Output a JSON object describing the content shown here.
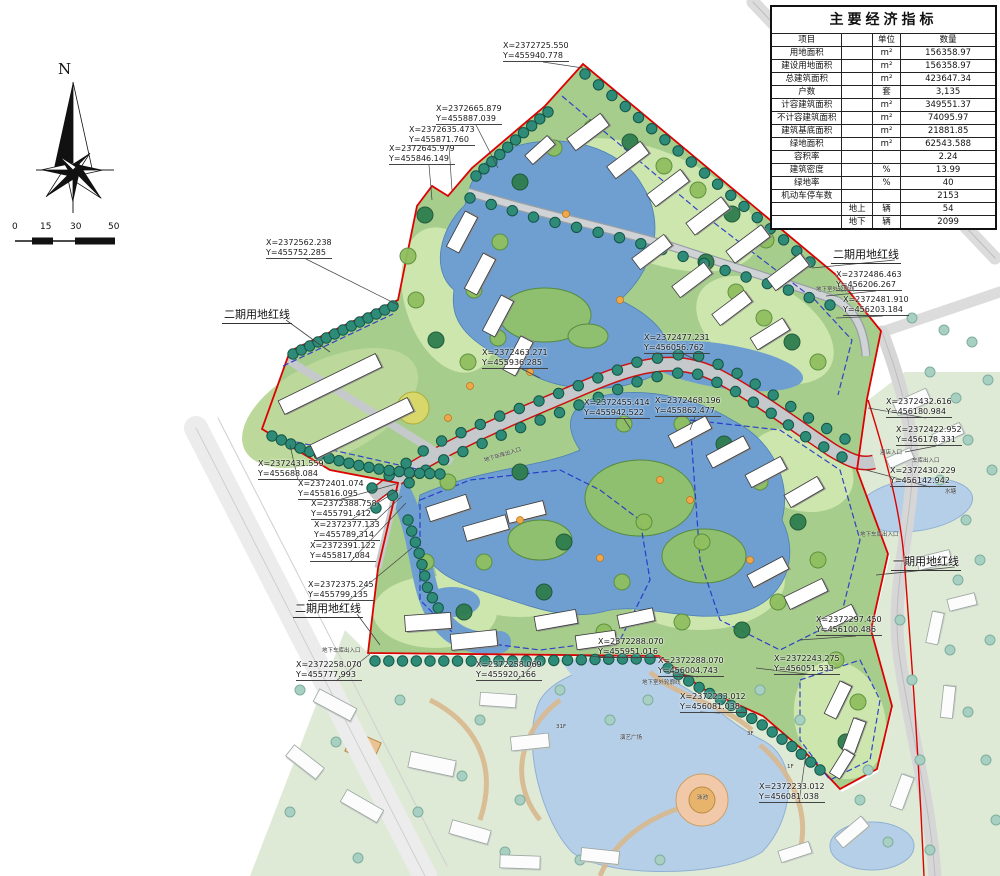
{
  "table": {
    "title": "主要经济指标",
    "header": {
      "item": "项目",
      "sub": "",
      "unit": "单位",
      "qty": "数量"
    },
    "rows": [
      {
        "item": "用地面积",
        "sub": "",
        "unit": "m²",
        "qty": "156358.97"
      },
      {
        "item": "建设用地面积",
        "sub": "",
        "unit": "m²",
        "qty": "156358.97"
      },
      {
        "item": "总建筑面积",
        "sub": "",
        "unit": "m²",
        "qty": "423647.34"
      },
      {
        "item": "户数",
        "sub": "",
        "unit": "套",
        "qty": "3,135"
      },
      {
        "item": "计容建筑面积",
        "sub": "",
        "unit": "m²",
        "qty": "349551.37"
      },
      {
        "item": "不计容建筑面积",
        "sub": "",
        "unit": "m²",
        "qty": "74095.97"
      },
      {
        "item": "建筑基底面积",
        "sub": "",
        "unit": "m²",
        "qty": "21881.85"
      },
      {
        "item": "绿地面积",
        "sub": "",
        "unit": "m²",
        "qty": "62543.588"
      },
      {
        "item": "容积率",
        "sub": "",
        "unit": "",
        "qty": "2.24"
      },
      {
        "item": "建筑密度",
        "sub": "",
        "unit": "%",
        "qty": "13.99"
      },
      {
        "item": "绿地率",
        "sub": "",
        "unit": "%",
        "qty": "40"
      },
      {
        "item": "机动车停车数",
        "sub": "",
        "unit": "",
        "qty": "2153"
      },
      {
        "item": "",
        "sub": "地上",
        "unit": "辆",
        "qty": "54"
      },
      {
        "item": "",
        "sub": "地下",
        "unit": "辆",
        "qty": "2099"
      }
    ]
  },
  "compass": {
    "label": "N"
  },
  "scalebar": {
    "ticks": [
      "0",
      "15",
      "30",
      "50"
    ]
  },
  "colors": {
    "boundary_red": "#dd0000",
    "garage_dashed_blue": "#2233cc",
    "water": "#6f9fd0",
    "site_green": "#a6cd8c",
    "phase1_green": "#dfead6"
  },
  "map": {
    "boundary_labels": [
      {
        "text": "二期用地红线",
        "x": 222,
        "y": 306,
        "tx": 330,
        "ty": 352
      },
      {
        "text": "二期用地红线",
        "x": 293,
        "y": 600,
        "tx": 380,
        "ty": 645
      },
      {
        "text": "二期用地红线",
        "x": 831,
        "y": 246,
        "tx": 812,
        "ty": 268
      },
      {
        "text": "一期用地红线",
        "x": 891,
        "y": 553,
        "tx": 876,
        "ty": 575
      }
    ],
    "coordinate_labels": [
      {
        "x": 503,
        "y": 41,
        "lines": [
          "X=2372725.550",
          "Y=455940.778"
        ],
        "tx": 583,
        "ty": 68
      },
      {
        "x": 436,
        "y": 104,
        "lines": [
          "X=2372665.879",
          "Y=455887.039"
        ],
        "tx": 498,
        "ty": 168
      },
      {
        "x": 409,
        "y": 125,
        "lines": [
          "X=2372635.473",
          "Y=455871.760"
        ],
        "tx": 452,
        "ty": 190
      },
      {
        "x": 389,
        "y": 144,
        "lines": [
          "X=2372645.979",
          "Y=455846.149"
        ],
        "tx": 432,
        "ty": 200
      },
      {
        "x": 266,
        "y": 238,
        "lines": [
          "X=2372562.238",
          "Y=455752.285"
        ],
        "tx": 398,
        "ty": 305
      },
      {
        "x": 258,
        "y": 459,
        "lines": [
          "X=2372431.559",
          "Y=455688.084"
        ],
        "tx": 290,
        "ty": 445
      },
      {
        "x": 298,
        "y": 479,
        "lines": [
          "X=2372401.074",
          "Y=455816.095"
        ],
        "tx": 396,
        "ty": 484
      },
      {
        "x": 311,
        "y": 499,
        "lines": [
          "X=2372388.758",
          "Y=455791.412"
        ],
        "tx": 398,
        "ty": 490
      },
      {
        "x": 314,
        "y": 520,
        "lines": [
          "X=2372377.133",
          "Y=455789.314"
        ],
        "tx": 402,
        "ty": 496
      },
      {
        "x": 310,
        "y": 541,
        "lines": [
          "X=2372391.122",
          "Y=455817.084"
        ],
        "tx": 406,
        "ty": 503
      },
      {
        "x": 308,
        "y": 580,
        "lines": [
          "X=2372375.245",
          "Y=455799.135"
        ],
        "tx": 412,
        "ty": 548
      },
      {
        "x": 296,
        "y": 660,
        "lines": [
          "X=2372258.070",
          "Y=455777.993"
        ],
        "tx": 370,
        "ty": 654
      },
      {
        "x": 476,
        "y": 660,
        "lines": [
          "X=2372258.069",
          "Y=455920.166"
        ],
        "tx": 540,
        "ty": 659
      },
      {
        "x": 598,
        "y": 637,
        "lines": [
          "X=2372288.070",
          "Y=455951.016"
        ],
        "tx": 585,
        "ty": 656
      },
      {
        "x": 658,
        "y": 656,
        "lines": [
          "X=2372288.070",
          "Y=456004.743"
        ],
        "tx": 668,
        "ty": 672
      },
      {
        "x": 680,
        "y": 692,
        "lines": [
          "X=2372233.012",
          "Y=456081.038"
        ],
        "tx": 700,
        "ty": 712
      },
      {
        "x": 759,
        "y": 782,
        "lines": [
          "X=2372233.012",
          "Y=456081.038"
        ],
        "tx": 806,
        "ty": 753
      },
      {
        "x": 482,
        "y": 348,
        "lines": [
          "X=2372463.271",
          "Y=455936.285"
        ],
        "tx": 540,
        "ty": 378
      },
      {
        "x": 644,
        "y": 333,
        "lines": [
          "X=2372477.231",
          "Y=456056.762"
        ],
        "tx": 700,
        "ty": 362
      },
      {
        "x": 584,
        "y": 398,
        "lines": [
          "X=2372455.414",
          "Y=455942.522"
        ],
        "tx": 630,
        "ty": 428
      },
      {
        "x": 655,
        "y": 396,
        "lines": [
          "X=2372468.196",
          "Y=455862.477"
        ],
        "tx": 690,
        "ty": 430
      },
      {
        "x": 836,
        "y": 270,
        "lines": [
          "X=2372486.463",
          "Y=456206.267"
        ],
        "tx": 826,
        "ty": 296
      },
      {
        "x": 843,
        "y": 295,
        "lines": [
          "X=2372481.910",
          "Y=456203.184"
        ],
        "tx": 836,
        "ty": 318
      },
      {
        "x": 886,
        "y": 397,
        "lines": [
          "X=2372432.616",
          "Y=456180.984"
        ],
        "tx": 868,
        "ty": 408
      },
      {
        "x": 896,
        "y": 425,
        "lines": [
          "X=2372422.952",
          "Y=456178.331"
        ],
        "tx": 905,
        "ty": 452
      },
      {
        "x": 890,
        "y": 466,
        "lines": [
          "X=2372430.229",
          "Y=456142.942"
        ],
        "tx": 866,
        "ty": 470
      },
      {
        "x": 816,
        "y": 615,
        "lines": [
          "X=2372297.450",
          "Y=456100.486"
        ],
        "tx": 800,
        "ty": 640
      },
      {
        "x": 774,
        "y": 654,
        "lines": [
          "X=2372243.275",
          "Y=456051.533"
        ],
        "tx": 756,
        "ty": 668
      }
    ],
    "feature_labels": [
      {
        "text": "地下车库出入口",
        "x": 484,
        "y": 456,
        "rot": -17
      },
      {
        "text": "地下车库出入口",
        "x": 322,
        "y": 646,
        "rot": 0
      },
      {
        "text": "酒店入口",
        "x": 880,
        "y": 448,
        "rot": 0
      },
      {
        "text": "车库出入口",
        "x": 912,
        "y": 456,
        "rot": 0
      },
      {
        "text": "水塘",
        "x": 945,
        "y": 487,
        "rot": 0
      },
      {
        "text": "地下车库出入口",
        "x": 860,
        "y": 530,
        "rot": 0
      },
      {
        "text": "地下室外轮廓线",
        "x": 816,
        "y": 285,
        "rot": 0
      },
      {
        "text": "地下室外轮廓线",
        "x": 642,
        "y": 678,
        "rot": 0
      },
      {
        "text": "演艺广场",
        "x": 620,
        "y": 733,
        "rot": 0
      },
      {
        "text": "泳池",
        "x": 697,
        "y": 793,
        "rot": 0
      },
      {
        "text": "31F",
        "x": 556,
        "y": 724,
        "rot": 0
      },
      {
        "text": "3F",
        "x": 747,
        "y": 731,
        "rot": 0
      },
      {
        "text": "1F",
        "x": 787,
        "y": 764,
        "rot": 0
      }
    ]
  }
}
